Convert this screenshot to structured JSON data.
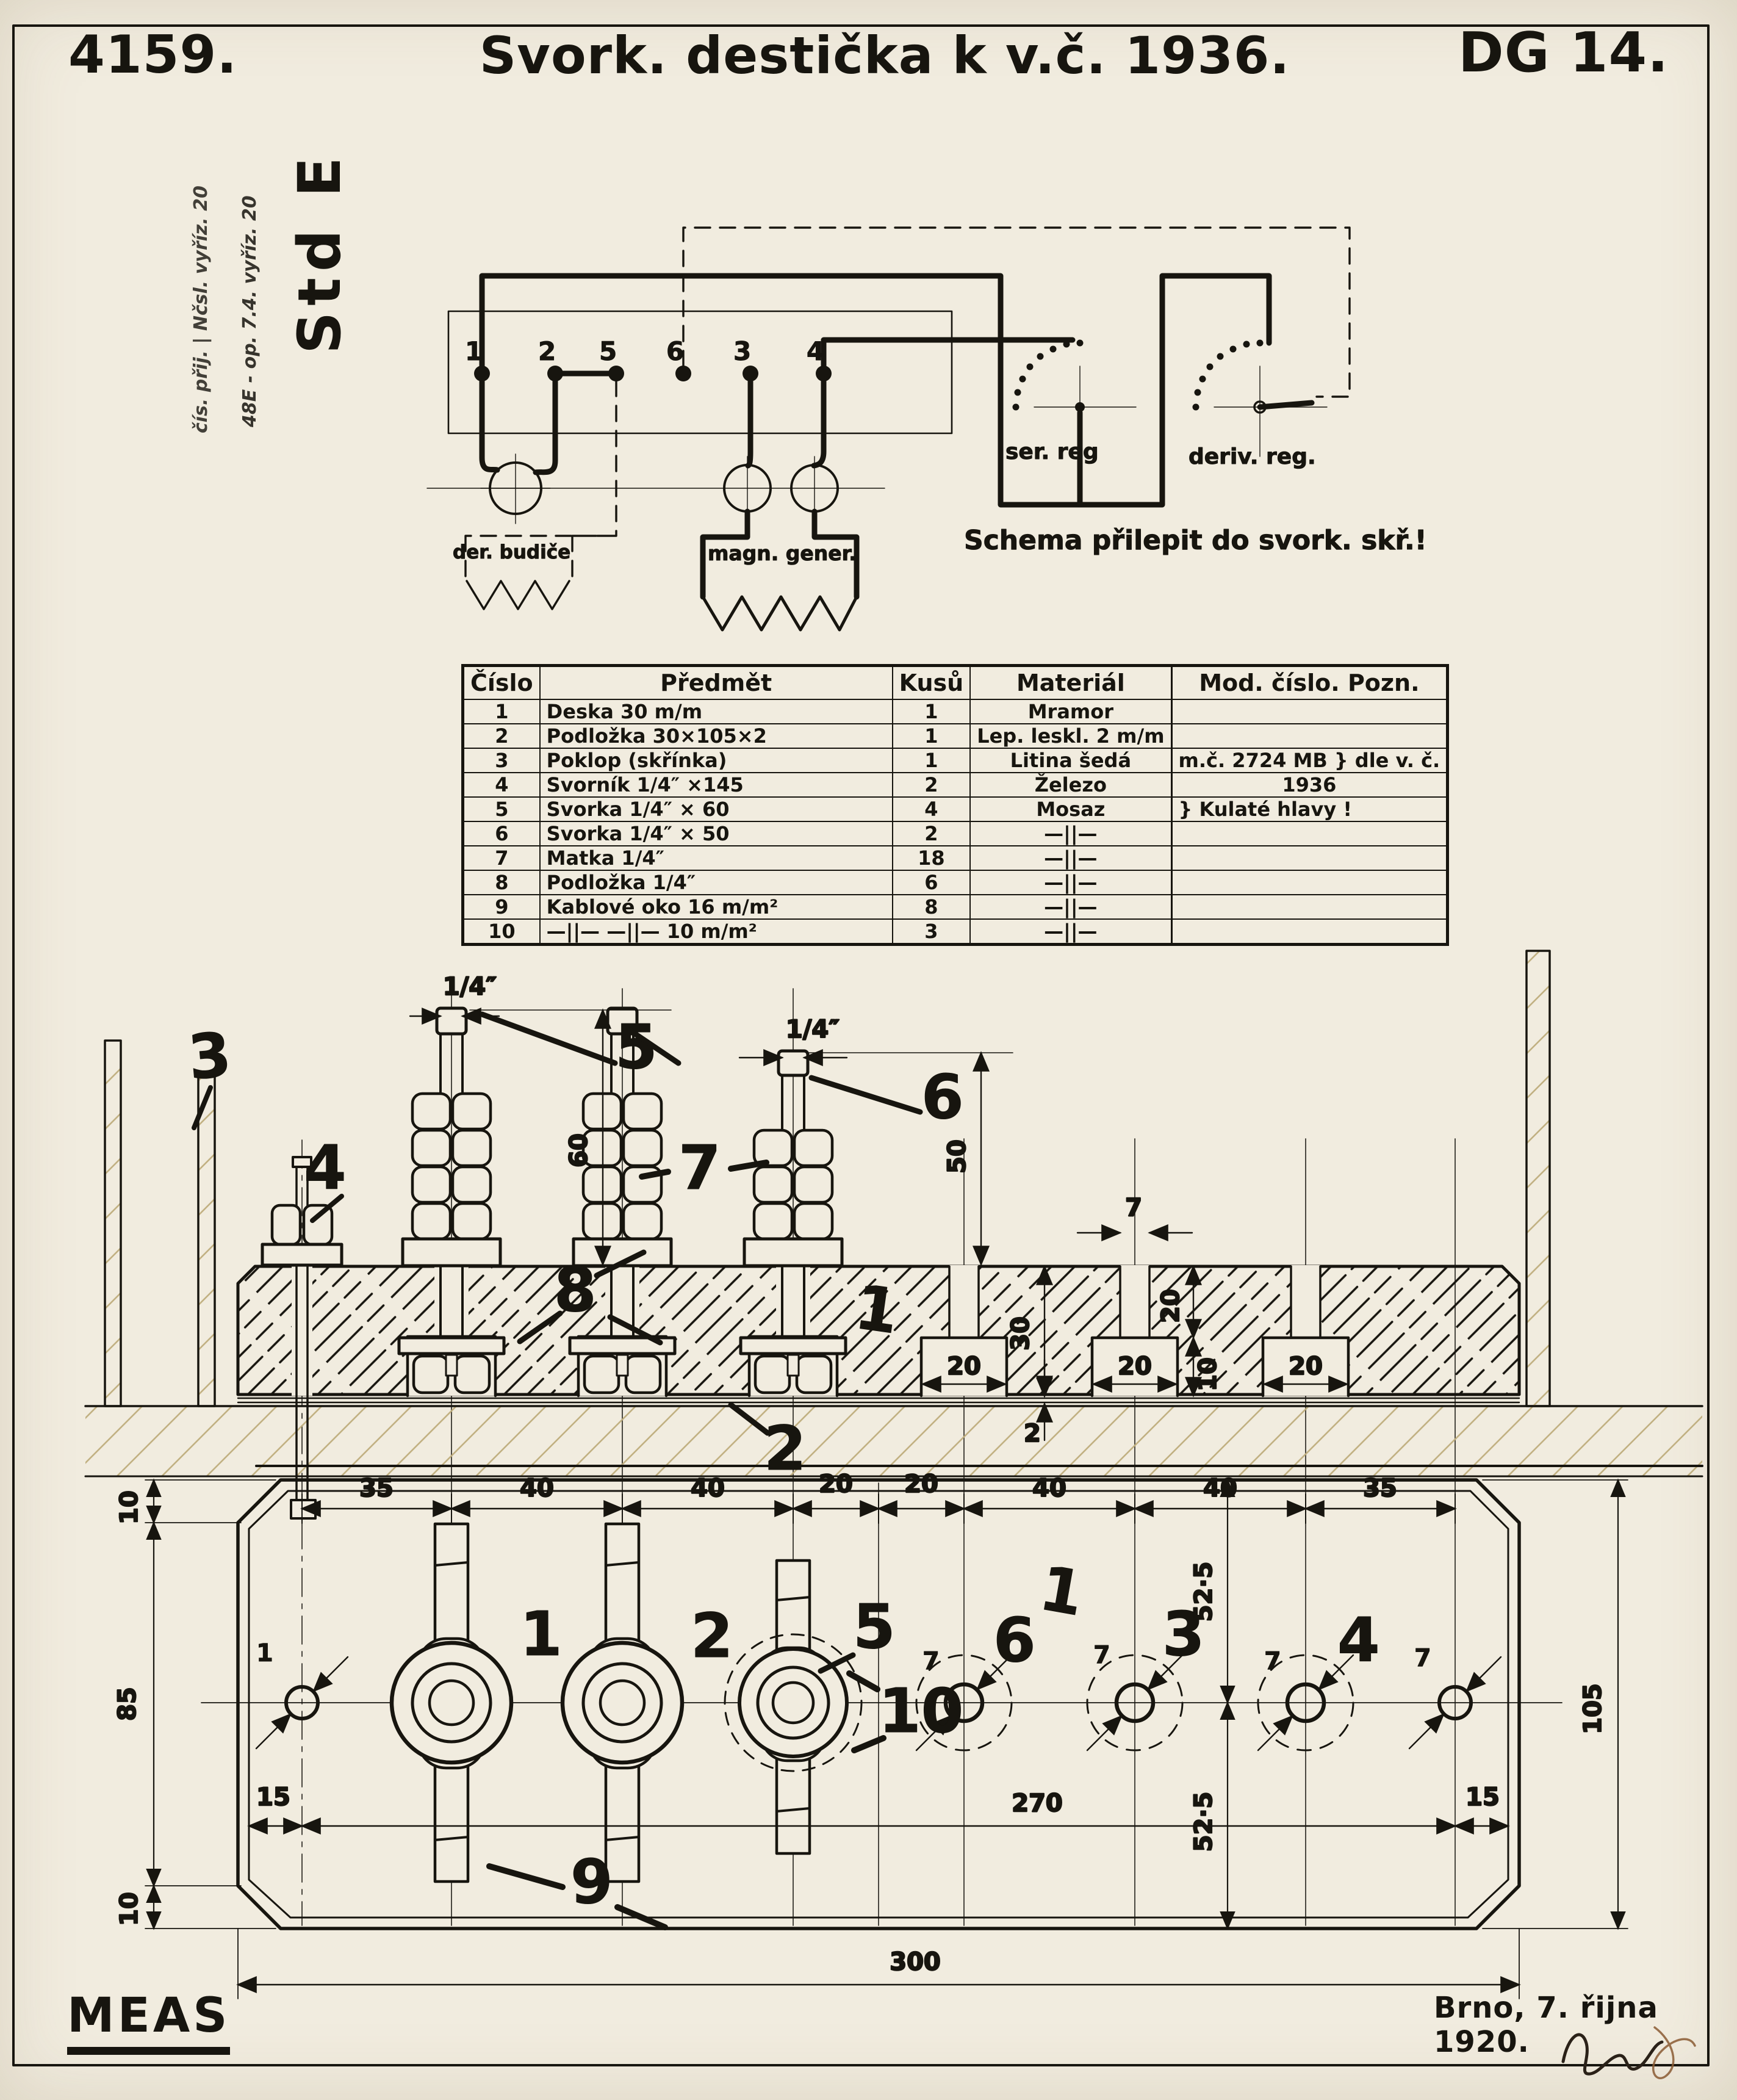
{
  "header": {
    "drawing_number": "4159.",
    "title": "Svork. destička k v.č. 1936.",
    "sheet_code": "DG 14."
  },
  "margin_notes": {
    "line1": "48E - op. 7.4. vyříz. 20",
    "line2": "čís. přij. | Nčsl. vyříz. 20",
    "stamp": "Std E"
  },
  "schematic": {
    "terminals": [
      "1",
      "2",
      "5",
      "6",
      "3",
      "4"
    ],
    "ser_reg_label": "ser. reg",
    "deriv_reg_label": "deriv. reg.",
    "der_budice_label": "der. budiče",
    "magn_gener_label": "magn. gener.",
    "note": "Schema přilepit do svork. skř.!"
  },
  "parts_table": {
    "headers": [
      "Číslo",
      "Předmět",
      "Kusů",
      "Materiál",
      "Mod. číslo. Pozn."
    ],
    "rows": [
      {
        "no": "1",
        "item": "Deska 30 m/m",
        "qty": "1",
        "mat": "Mramor",
        "note": ""
      },
      {
        "no": "2",
        "item": "Podložka 30×105×2",
        "qty": "1",
        "mat": "Lep. leskl. 2 m/m",
        "note": ""
      },
      {
        "no": "3",
        "item": "Poklop (skřínka)",
        "qty": "1",
        "mat": "Litina šedá",
        "note": "m.č. 2724 MB }  dle v. č."
      },
      {
        "no": "4",
        "item": "Svorník 1/4″ ×145",
        "qty": "2",
        "mat": "Železo",
        "note": "1936"
      },
      {
        "no": "5",
        "item": "Svorka 1/4″ × 60",
        "qty": "4",
        "mat": "Mosaz",
        "note": "} Kulaté hlavy !"
      },
      {
        "no": "6",
        "item": "Svorka 1/4″ × 50",
        "qty": "2",
        "mat": "—||—",
        "note": ""
      },
      {
        "no": "7",
        "item": "Matka 1/4″",
        "qty": "18",
        "mat": "—||—",
        "note": ""
      },
      {
        "no": "8",
        "item": "Podložka 1/4″",
        "qty": "6",
        "mat": "—||—",
        "note": ""
      },
      {
        "no": "9",
        "item": "Kablové oko 16 m/m²",
        "qty": "8",
        "mat": "—||—",
        "note": ""
      },
      {
        "no": "10",
        "item": "—||—  —||—  10 m/m²",
        "qty": "3",
        "mat": "—||—",
        "note": ""
      }
    ]
  },
  "section_view": {
    "callouts": {
      "c1": "1",
      "c2": "2",
      "c3": "3",
      "c4": "4",
      "c5": "5",
      "c6": "6",
      "c7": "7",
      "c8": "8"
    },
    "dims": {
      "quarter_inch_a": "1/4″",
      "quarter_inch_b": "1/4″",
      "h60": "60",
      "h50": "50",
      "w7": "7",
      "t30": "30",
      "v20": "20",
      "v10": "10",
      "t2": "2",
      "slot_a": "20",
      "slot_b": "20",
      "slot_c": "20"
    }
  },
  "plan_view": {
    "chain": [
      "35",
      "40",
      "40",
      "20",
      "20",
      "40",
      "40",
      "35"
    ],
    "dims": {
      "d270": "270",
      "d300": "300",
      "d15l": "15",
      "d15r": "15",
      "v10t": "10",
      "v85": "85",
      "v10b": "10",
      "v52a": "52·5",
      "v52b": "52·5",
      "v105": "105",
      "hole_dia": "7"
    },
    "labels": {
      "t1": "1",
      "t2": "2",
      "t5": "5",
      "h6": "6",
      "h3": "3",
      "h4": "4",
      "c9": "9",
      "c10": "10",
      "plate": "1",
      "left_hole": "1"
    }
  },
  "footer": {
    "logo": "MEAS",
    "place_date": "Brno, 7. řijna 1920."
  }
}
